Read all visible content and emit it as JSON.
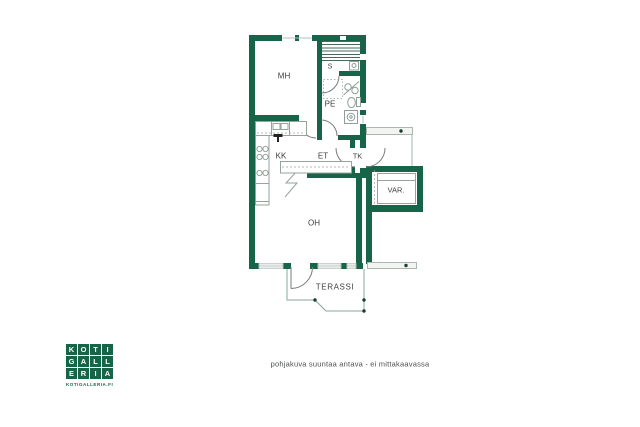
{
  "floorplan": {
    "rooms": {
      "mh": "MH",
      "s": "S",
      "pe": "PE",
      "kk": "KK",
      "et": "ET",
      "tk": "TK",
      "oh": "OH",
      "var": "VAR.",
      "terassi": "TERASSI"
    },
    "caption": "pohjakuva suuntaa antava - ei mittakaavassa"
  },
  "logo": {
    "letters": [
      "K",
      "O",
      "T",
      "I",
      "G",
      "A",
      "L",
      "L",
      "E",
      "R",
      "I",
      "A"
    ],
    "website": "KOTIGALLERIA.FI"
  },
  "colors": {
    "wall_green": "#176549",
    "fixture_gray": "#8f9e97",
    "terrace_green": "#86a898",
    "text": "#3c3f3d"
  }
}
